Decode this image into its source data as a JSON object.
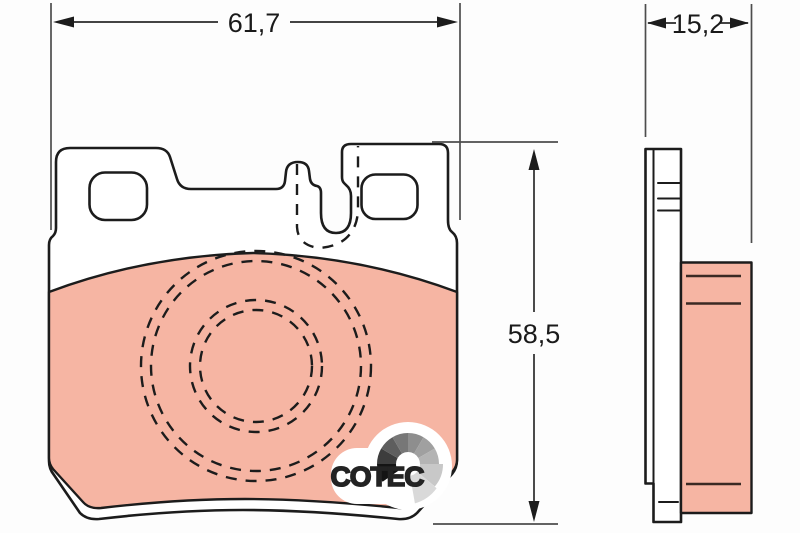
{
  "drawing": {
    "type": "brake-pad-dimension-drawing",
    "views": {
      "front_view": "pad-front-outline-with-friction-surface",
      "side_view": "pad-thickness-profile"
    }
  },
  "dimensions": {
    "width": {
      "label": "61,7"
    },
    "height": {
      "label": "58,5"
    },
    "thickness": {
      "label": "15,2"
    }
  },
  "logo": {
    "text": "COTEC",
    "icon": "gauge-fan-icon"
  },
  "colors": {
    "background": "#fdfdfd",
    "friction_material": "#f6b5a3",
    "outline": "#1c1c1c",
    "dimension_line": "#4d4d4d",
    "logo_text": "#232323"
  }
}
